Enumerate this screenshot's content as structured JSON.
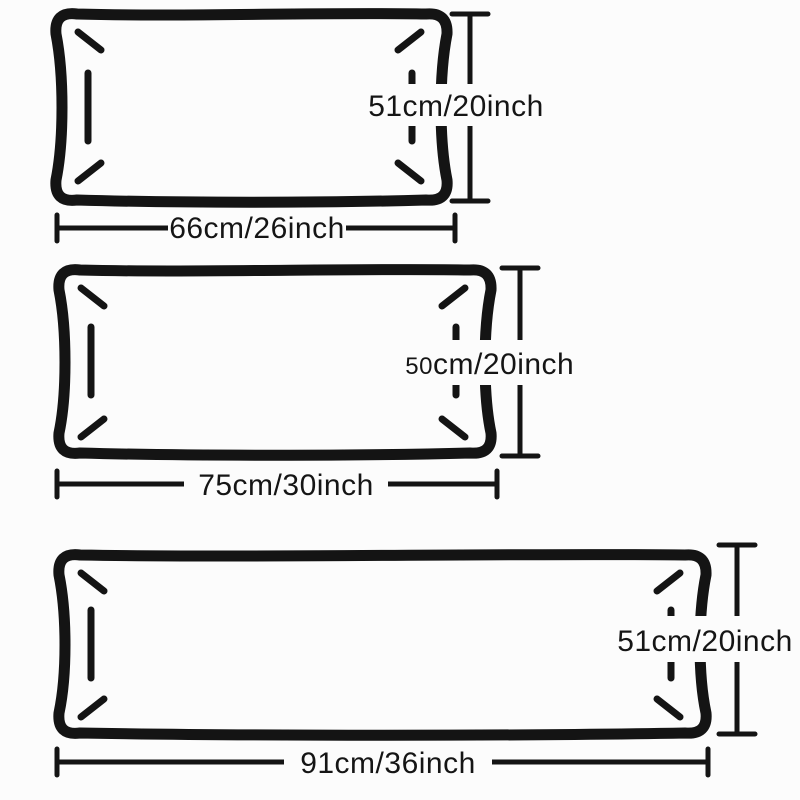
{
  "colors": {
    "ink": "#141414",
    "paper": "#fcfcfc",
    "text": "#151515"
  },
  "diagram_type": "pillow-size-guide",
  "pillow_sizes": [
    {
      "height_label": "51cm/20inch",
      "width_label": "66cm/26inch"
    },
    {
      "height_label_small": "50",
      "height_label_rest": "cm/20inch",
      "width_label": "75cm/30inch"
    },
    {
      "height_label": "51cm/20inch",
      "width_label": "91cm/36inch"
    }
  ]
}
